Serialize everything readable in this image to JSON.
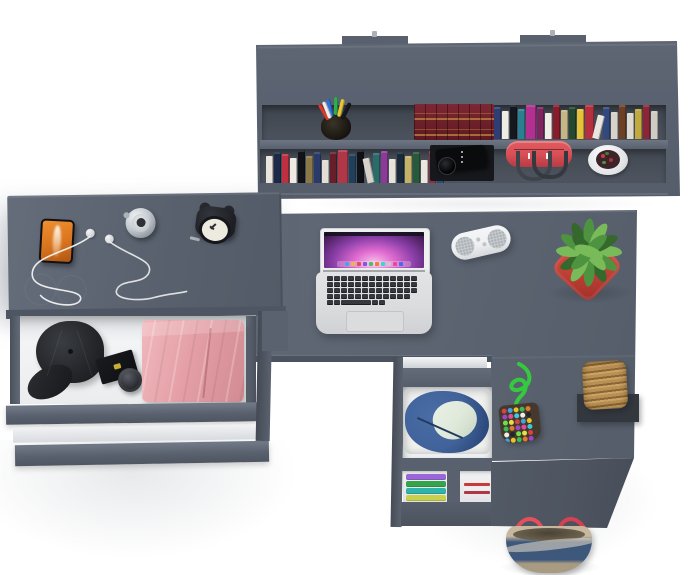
{
  "scene": {
    "title": "Anthracite grey L-shaped study desk set with wall shelf, open drawers and accessories - top view product render",
    "furniture_color_name": "anthracite grey",
    "objects": [
      "wall shelf with two mounting tabs",
      "pen cup",
      "antique red-gold book set",
      "book rows",
      "black camera",
      "red duffel bag",
      "white bowl planter",
      "smartphone with orange screen",
      "white earphones with cable",
      "silver pocket watch",
      "black alarm clock",
      "open drawer with black cap, gift box, cream jar and folded pink pants",
      "open laptop with pink aurora wallpaper",
      "white capsule bluetooth speaker",
      "green succulent in red square pot",
      "wicker basket on black stand",
      "beaded pouch on green cord",
      "lower cabinet with denim jacket drawer and folded clothes",
      "denim and beige tote bag with red straps"
    ]
  },
  "palette": {
    "bg": "#ffffff",
    "panel": "#5b6370",
    "panel_light": "#6e7684",
    "panel_edge": "#7b8391",
    "recess": "#474d57",
    "recess_dark": "#16181c",
    "desk": "#5c6471",
    "desk_front": "#4b5260",
    "face": "#4e5561",
    "white_drawer": "#f3f4f6",
    "white_drawer_dim": "#dfe2e5",
    "metal": "#aab1b9",
    "cap": "#232528",
    "cap_dark": "#17181b",
    "pants": "#e4a0a6",
    "pants_light": "#f0b8bc",
    "pants_dark": "#d28b92",
    "phone_orange": "#ef9030",
    "phone_orange_dark": "#b05612",
    "clock_body": "#1d1f24",
    "clock_face": "#edeae0",
    "watch_silver": "#c3c9d0",
    "red_bag": "#d95057",
    "red_bag_dark": "#b73b44",
    "strap_dark": "#3f434b",
    "pot_white": "#f2f3f4",
    "plant_pot_red": "#c8453a",
    "plant_pot_red_dark": "#9e2f28",
    "plant": "#4e9440",
    "plant_light": "#78bb58",
    "plant_dark": "#35682c",
    "wicker": "#b2894e",
    "wicker_dark": "#8a6535",
    "stand": "#33373e",
    "rope": "#35c93f",
    "pouch": "#44392c",
    "denim": "#41629a",
    "denim_dark": "#2c4a7c",
    "lining": "#dfe9da",
    "cloth": "#f0f1ee",
    "tote_beige": "#b9aa92",
    "tote_denim": "#3e587c",
    "tote_red": "#e84e5c",
    "tote_inner": "#6e6450",
    "speaker": "#eef0f2",
    "speaker_gray": "#c9cdd1",
    "key": "#36383d",
    "laptop_body": "#d9dbdd",
    "screen_deep": "#2c1038",
    "screen_purple": "#8a3fa8",
    "screen_pink": "#e06ad0",
    "screen_glow": "#f7c0ea",
    "antique_red": "#5f1822",
    "antique_red_light": "#7d2833",
    "gold": "#c9973f"
  },
  "hutch": {
    "upper_books": [
      {
        "c": "#2e3e74",
        "h": 32
      },
      {
        "c": "#efece4",
        "h": 28
      },
      {
        "c": "#14181f",
        "h": 34
      },
      {
        "c": "#2b7f93",
        "h": 30
      },
      {
        "c": "#b2308f",
        "h": 34,
        "w": 10
      },
      {
        "c": "#7e2460",
        "h": 32
      },
      {
        "c": "#f0ede6",
        "h": 26
      },
      {
        "c": "#891c2b",
        "h": 34
      },
      {
        "c": "#c7b685",
        "h": 29
      },
      {
        "c": "#24492f",
        "h": 32
      },
      {
        "c": "#e3c337",
        "h": 30
      },
      {
        "c": "#b52f3e",
        "h": 34,
        "w": 9
      },
      {
        "c": "#e9e6df",
        "h": 24,
        "r": 14
      },
      {
        "c": "#31497f",
        "h": 32
      },
      {
        "c": "#d7d3ca",
        "h": 27
      },
      {
        "c": "#6e4023",
        "h": 34
      },
      {
        "c": "#ddd9d1",
        "h": 26
      },
      {
        "c": "#c0a93e",
        "h": 30
      },
      {
        "c": "#8c2636",
        "h": 34
      },
      {
        "c": "#d0ccc3",
        "h": 28
      }
    ],
    "lower_books": [
      {
        "c": "#e9e5dc",
        "h": 27
      },
      {
        "c": "#1d2946",
        "h": 31
      },
      {
        "c": "#bf2f40",
        "h": 29
      },
      {
        "c": "#efebe2",
        "h": 25
      },
      {
        "c": "#101419",
        "h": 33
      },
      {
        "c": "#8a7847",
        "h": 27
      },
      {
        "c": "#2a3a6b",
        "h": 31
      },
      {
        "c": "#e2ded5",
        "h": 23
      },
      {
        "c": "#681e29",
        "h": 31
      },
      {
        "c": "#b03747",
        "h": 33,
        "w": 10
      },
      {
        "c": "#213f5b",
        "h": 29
      },
      {
        "c": "#0e1115",
        "h": 33
      },
      {
        "c": "#d6d2c9",
        "h": 25,
        "r": -12
      },
      {
        "c": "#2a6b6b",
        "h": 30
      },
      {
        "c": "#8c3a99",
        "h": 32
      },
      {
        "c": "#e7e3da",
        "h": 24
      },
      {
        "c": "#192a3b",
        "h": 31
      },
      {
        "c": "#c6b267",
        "h": 27
      },
      {
        "c": "#27593b",
        "h": 31
      },
      {
        "c": "#ebe7de",
        "h": 23
      },
      {
        "c": "#8e2f3f",
        "h": 32
      },
      {
        "c": "#2a4a7b",
        "h": 30
      }
    ],
    "pens": [
      {
        "c": "#d43a2e",
        "x": 2,
        "y": 2,
        "r": -30
      },
      {
        "c": "#2f6fd8",
        "x": 8,
        "y": -2,
        "r": -12
      },
      {
        "c": "#2fae4e",
        "x": 14,
        "y": -4,
        "r": 2
      },
      {
        "c": "#e8c83a",
        "x": 19,
        "y": -2,
        "r": 14
      },
      {
        "c": "#17191c",
        "x": 24,
        "y": 1,
        "r": 26
      },
      {
        "c": "#ececec",
        "x": 5,
        "y": 0,
        "r": -22
      }
    ]
  },
  "laptop": {
    "dock_icons": [
      "#4aa3e8",
      "#e8b93a",
      "#d85555",
      "#7a5ad8",
      "#4ac06a",
      "#e87f3a",
      "#3ad8c8",
      "#c8c8cc",
      "#e84a9a",
      "#4a6ae8"
    ],
    "key_rows": [
      {
        "count": 13
      },
      {
        "count": 13
      },
      {
        "count": 13
      },
      {
        "count": 12
      },
      {
        "widths": [
          6,
          6,
          30,
          6,
          6
        ]
      }
    ]
  },
  "pouch": {
    "bead_colors": [
      "#d94242",
      "#3da4e0",
      "#e8c32f",
      "#37bd55",
      "#e07a2e",
      "#9c46c8",
      "#e04b9e",
      "#3ecadb",
      "#f0eee8",
      "#23252a",
      "#6ee04a",
      "#e0e04a"
    ],
    "bead_count": 36
  },
  "clothes": {
    "left_stack": [
      "#9a66d8",
      "#35a54c",
      "#2fb3ab",
      "#c9d04a"
    ],
    "right_stack": [
      "#efefef",
      "#c83b3b",
      "#efefef",
      "#b03747",
      "#e8e8ea"
    ]
  },
  "plant": {
    "leaves": [
      {
        "x": 49,
        "y": 40,
        "r": 0
      },
      {
        "x": 46,
        "y": 50,
        "r": 30
      },
      {
        "x": 40,
        "y": 57,
        "r": 60
      },
      {
        "x": 31,
        "y": 60,
        "r": 90
      },
      {
        "x": 22,
        "y": 57,
        "r": 120
      },
      {
        "x": 16,
        "y": 50,
        "r": 150
      },
      {
        "x": 13,
        "y": 40,
        "r": 180
      },
      {
        "x": 16,
        "y": 32,
        "r": 210
      },
      {
        "x": 22,
        "y": 25,
        "r": 240
      },
      {
        "x": 31,
        "y": 22,
        "r": 270
      },
      {
        "x": 40,
        "y": 25,
        "r": 300
      },
      {
        "x": 46,
        "y": 32,
        "r": 330
      },
      {
        "x": 37,
        "y": 47,
        "r": 45
      },
      {
        "x": 25,
        "y": 47,
        "r": 135
      },
      {
        "x": 25,
        "y": 34,
        "r": 225
      },
      {
        "x": 37,
        "y": 34,
        "r": 315
      },
      {
        "x": 31,
        "y": 40,
        "r": 20
      }
    ]
  }
}
